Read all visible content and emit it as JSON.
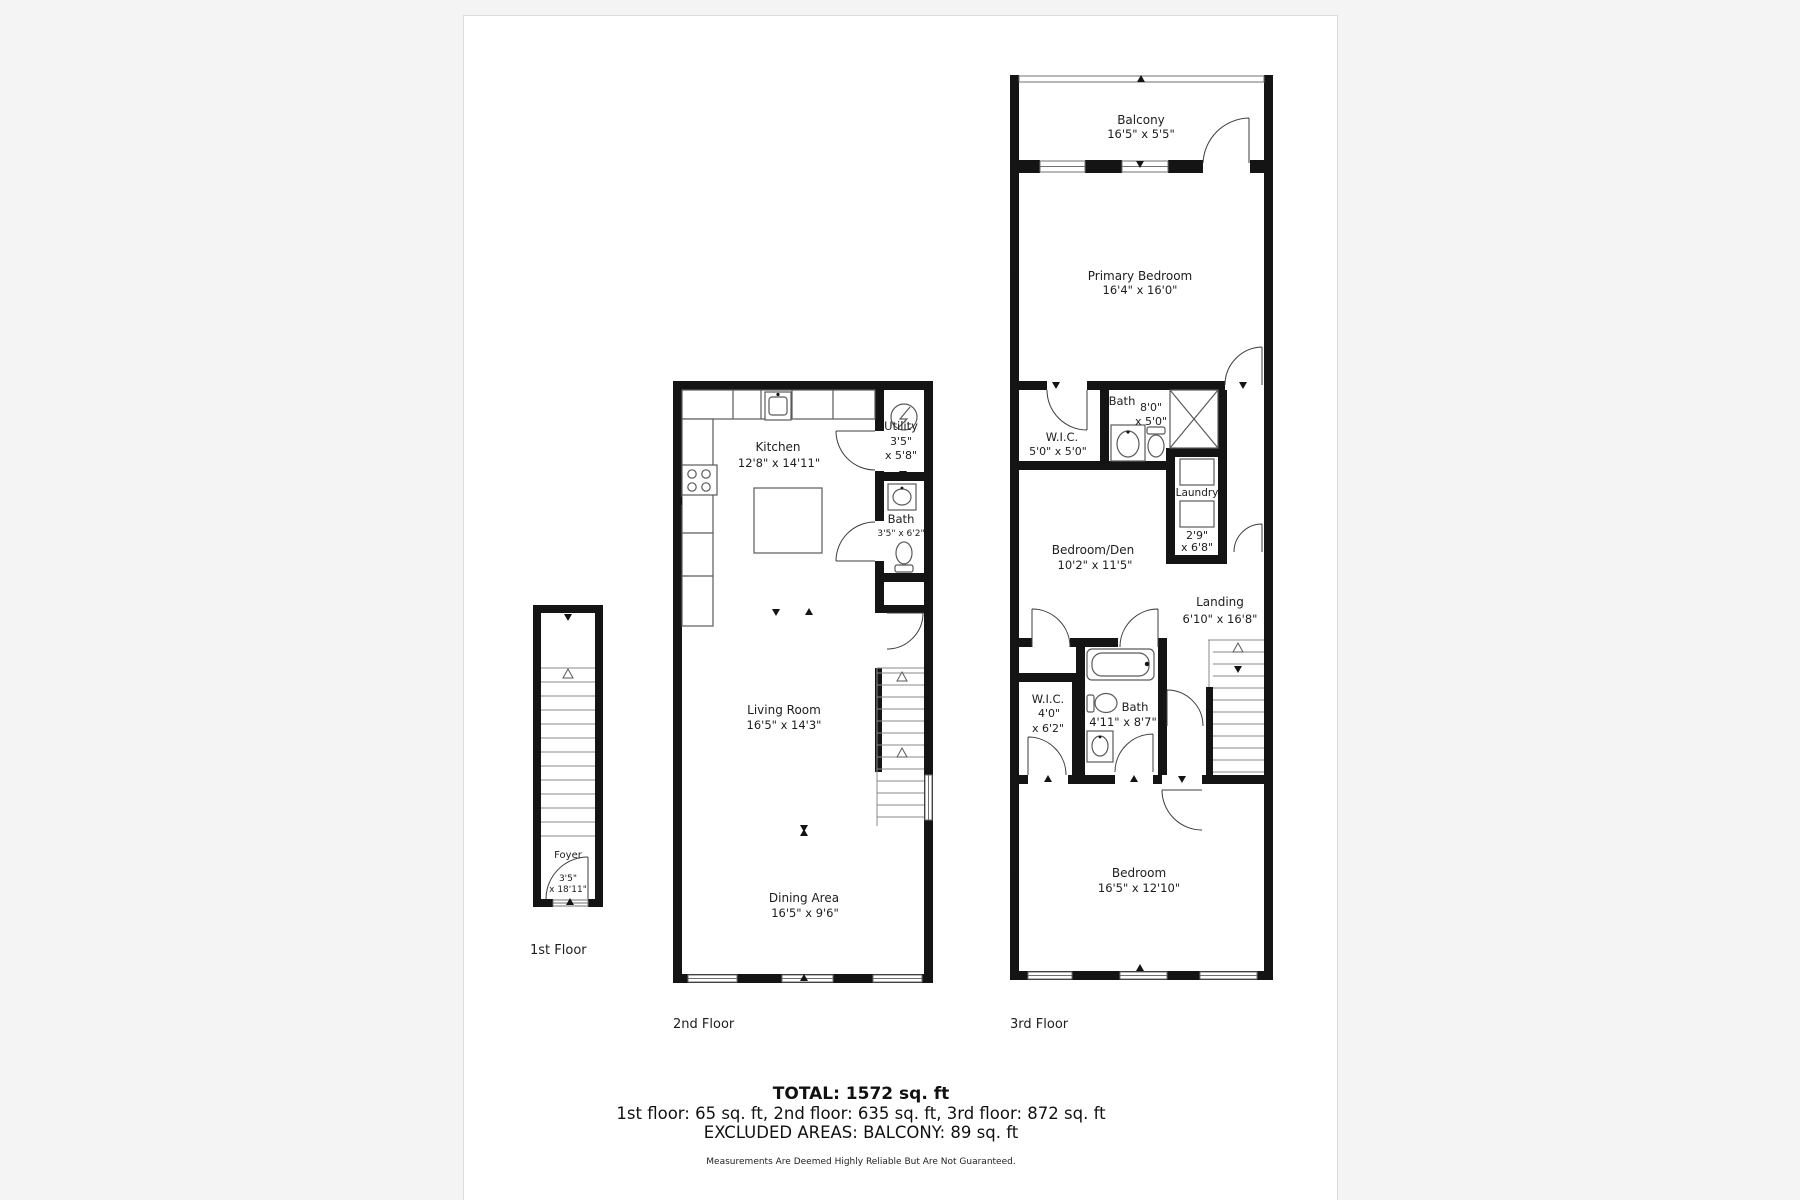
{
  "colors": {
    "page_bg": "#f4f4f4",
    "panel_border": "#dcdcdc",
    "wall": "#141414",
    "text": "#1d1d1d",
    "fixture": "#5a5a5a",
    "stair": "#8a8a8a",
    "door": "#3c3c3c",
    "window_line": "#6f6f6f"
  },
  "floors": {
    "first": {
      "label": "1st Floor",
      "foyer_name": "Foyer",
      "foyer_dim1": "3'5\"",
      "foyer_dim2": "x 18'11\""
    },
    "second": {
      "label": "2nd Floor",
      "kitchen_name": "Kitchen",
      "kitchen_dims": "12'8\" x 14'11\"",
      "utility_name": "Utility",
      "utility_dim1": "3'5\"",
      "utility_dim2": "x 5'8\"",
      "bath_name": "Bath",
      "bath_dims": "3'5\" x 6'2\"",
      "living_name": "Living Room",
      "living_dims": "16'5\" x 14'3\"",
      "dining_name": "Dining Area",
      "dining_dims": "16'5\" x 9'6\""
    },
    "third": {
      "label": "3rd Floor",
      "balcony_name": "Balcony",
      "balcony_dims": "16'5\" x 5'5\"",
      "primary_name": "Primary Bedroom",
      "primary_dims": "16'4\" x 16'0\"",
      "wic1_name": "W.I.C.",
      "wic1_dims": "5'0\" x 5'0\"",
      "bath1_name": "Bath",
      "bath1_dim1": "8'0\"",
      "bath1_dim2": "x 5'0\"",
      "laundry_name": "Laundry",
      "laundry_dim1": "2'9\"",
      "laundry_dim2": "x 6'8\"",
      "den_name": "Bedroom/Den",
      "den_dims": "10'2\" x 11'5\"",
      "landing_name": "Landing",
      "landing_dims": "6'10\" x 16'8\"",
      "wic2_name": "W.I.C.",
      "wic2_dim1": "4'0\"",
      "wic2_dim2": "x 6'2\"",
      "bath2_name": "Bath",
      "bath2_dims": "4'11\" x 8'7\"",
      "bedroom_name": "Bedroom",
      "bedroom_dims": "16'5\" x 12'10\""
    }
  },
  "summary": {
    "total": "TOTAL: 1572 sq. ft",
    "floors_line": "1st floor: 65 sq. ft, 2nd floor: 635 sq. ft, 3rd floor: 872 sq. ft",
    "excluded_line": "EXCLUDED AREAS: BALCONY: 89 sq. ft",
    "disclaimer": "Measurements Are Deemed Highly Reliable But Are Not Guaranteed."
  }
}
